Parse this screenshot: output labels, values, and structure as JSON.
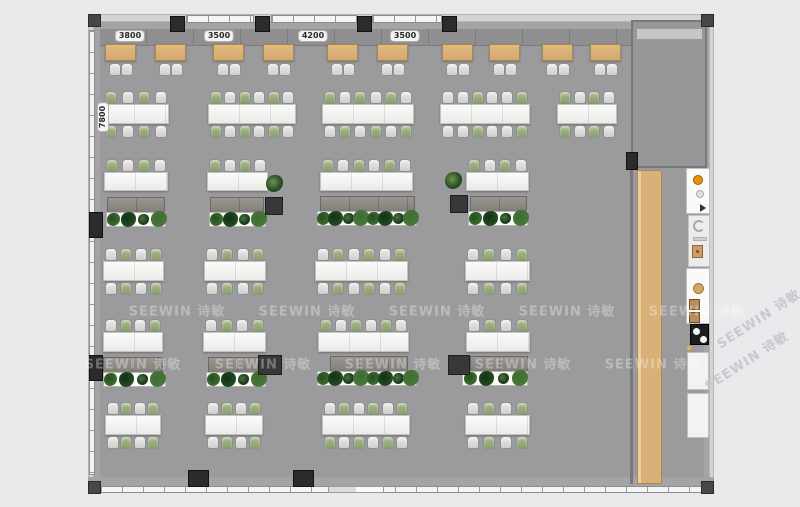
{
  "page": {
    "type": "office-floor-plan-rendering",
    "bg": "#e9eaec"
  },
  "watermark": {
    "text": "SEEWIN 诗敏",
    "color": "rgba(255,255,255,0.32)",
    "margin_color": "rgba(198,198,204,0.95)",
    "horizontal": [
      {
        "cx": 177,
        "cy": 310
      },
      {
        "cx": 307,
        "cy": 310
      },
      {
        "cx": 437,
        "cy": 310
      },
      {
        "cx": 567,
        "cy": 310
      },
      {
        "cx": 697,
        "cy": 310
      },
      {
        "cx": 133,
        "cy": 363
      },
      {
        "cx": 263,
        "cy": 363
      },
      {
        "cx": 393,
        "cy": 363
      },
      {
        "cx": 523,
        "cy": 363
      },
      {
        "cx": 653,
        "cy": 363
      }
    ],
    "diagonal": [
      {
        "cx": 758,
        "cy": 318,
        "rot": -33
      },
      {
        "cx": 746,
        "cy": 360,
        "rot": -33
      }
    ]
  },
  "dimensions": {
    "top": [
      {
        "label": "3800",
        "cx": 130,
        "cy": 36
      },
      {
        "label": "3500",
        "cx": 219,
        "cy": 36
      },
      {
        "label": "4200",
        "cx": 313,
        "cy": 36
      },
      {
        "label": "3500",
        "cx": 405,
        "cy": 36
      }
    ],
    "side": {
      "label": "7800",
      "cx": 103,
      "cy": 117,
      "rot": -90
    }
  },
  "palette": {
    "floor": "#9b9b9d",
    "wall_light": "#d4d4d6",
    "wall_dark": "#a4a4a6",
    "column": "#2b2b2d",
    "desk_tan": "#d8b078",
    "table_white": "#f5f5f3",
    "chair_white": "#d8d8d6",
    "chair_green": "#93a878",
    "credenza_gray": "#8e8a86",
    "plant_green": "#2c5124",
    "bench_wood": "#d8b078",
    "accent_orange": "#e8920a",
    "accent_yellow": "#e8c01c",
    "cooktop_black": "#1d1d1f"
  },
  "structure": {
    "columns_top_x": [
      170,
      255,
      357,
      442
    ],
    "columns_bottom_x": [
      188,
      293
    ],
    "columns_left_y": [
      212,
      355
    ],
    "corner_caps": [
      [
        88,
        14
      ],
      [
        701,
        14
      ],
      [
        88,
        481
      ],
      [
        701,
        481
      ]
    ],
    "corridor_column": [
      626,
      152
    ]
  },
  "furniture": {
    "row_y": {
      "1": {
        "desk": 44,
        "chairs": 63
      },
      "2": {
        "ct": 91,
        "t": 104,
        "th": 20,
        "cb": 125
      },
      "3": {
        "ct": 159,
        "t": 172,
        "th": 19
      },
      "4": {
        "ct": 248,
        "t": 261,
        "th": 20,
        "cb": 282
      },
      "5": {
        "ct": 319,
        "t": 332,
        "th": 20
      },
      "6": {
        "ct": 402,
        "t": 415,
        "th": 20,
        "cb": 436
      }
    },
    "tan_desk_xs": [
      105,
      155,
      213,
      263,
      327,
      377,
      442,
      489,
      542,
      590
    ],
    "clusters": [
      {
        "row": "2",
        "x": 103,
        "w": 66,
        "top": "GWGW",
        "bot": "GWGW"
      },
      {
        "row": "2",
        "x": 208,
        "w": 88,
        "top": "GWGWGW",
        "bot": "GWGWGW"
      },
      {
        "row": "2",
        "x": 322,
        "w": 92,
        "top": "GWGWGW",
        "bot": "WGWGWG"
      },
      {
        "row": "2",
        "x": 440,
        "w": 90,
        "top": "WWGWWG",
        "bot": "WWGWWG"
      },
      {
        "row": "2",
        "x": 557,
        "w": 60,
        "top": "GWGW",
        "bot": "GWGW"
      },
      {
        "row": "3",
        "x": 104,
        "w": 64,
        "top": "GWGW"
      },
      {
        "row": "3",
        "x": 207,
        "w": 61,
        "top": "GWGW"
      },
      {
        "row": "3",
        "x": 320,
        "w": 93,
        "top": "GWGWGW"
      },
      {
        "row": "3",
        "x": 466,
        "w": 63,
        "top": "GWGW"
      },
      {
        "row": "4",
        "x": 103,
        "w": 61,
        "top": "WGWG",
        "bot": "WGWG"
      },
      {
        "row": "4",
        "x": 204,
        "w": 62,
        "top": "WGWG",
        "bot": "WGWG"
      },
      {
        "row": "4",
        "x": 315,
        "w": 93,
        "top": "WGWGWG",
        "bot": "WGWGWG"
      },
      {
        "row": "4",
        "x": 465,
        "w": 65,
        "top": "WGWG",
        "bot": "WGWG"
      },
      {
        "row": "5",
        "x": 103,
        "w": 60,
        "top": "WGWG"
      },
      {
        "row": "5",
        "x": 203,
        "w": 63,
        "top": "WGWG"
      },
      {
        "row": "5",
        "x": 318,
        "w": 91,
        "top": "GWGWGW"
      },
      {
        "row": "5",
        "x": 466,
        "w": 64,
        "top": "WGWG"
      },
      {
        "row": "6",
        "x": 105,
        "w": 56,
        "top": "WGWG",
        "bot": "WGWG"
      },
      {
        "row": "6",
        "x": 205,
        "w": 58,
        "top": "WGWG",
        "bot": "WGWG"
      },
      {
        "row": "6",
        "x": 322,
        "w": 88,
        "top": "WGWGWG",
        "bot": "GWGWGW"
      },
      {
        "row": "6",
        "x": 465,
        "w": 65,
        "top": "WGWG",
        "bot": "WGWG"
      }
    ],
    "credenzas": [
      {
        "x": 107,
        "y": 197,
        "w": 58
      },
      {
        "x": 210,
        "y": 197,
        "w": 54
      },
      {
        "x": 320,
        "y": 196,
        "w": 95
      },
      {
        "x": 470,
        "y": 196,
        "w": 57
      },
      {
        "x": 103,
        "y": 357,
        "w": 60
      },
      {
        "x": 208,
        "y": 357,
        "w": 57
      },
      {
        "x": 330,
        "y": 356,
        "w": 78
      },
      {
        "x": 470,
        "y": 356,
        "w": 58
      }
    ],
    "planters": [
      {
        "x": 106,
        "y": 212,
        "w": 60,
        "n": 4
      },
      {
        "x": 209,
        "y": 212,
        "w": 57,
        "n": 4
      },
      {
        "x": 317,
        "y": 211,
        "w": 100,
        "n": 8
      },
      {
        "x": 468,
        "y": 211,
        "w": 60,
        "n": 4
      },
      {
        "x": 103,
        "y": 372,
        "w": 63,
        "n": 4
      },
      {
        "x": 206,
        "y": 372,
        "w": 60,
        "n": 4
      },
      {
        "x": 317,
        "y": 371,
        "w": 100,
        "n": 8
      },
      {
        "x": 462,
        "y": 371,
        "w": 66,
        "n": 4
      }
    ],
    "dark_cabinets": [
      {
        "x": 265,
        "y": 197,
        "w": 18,
        "h": 18
      },
      {
        "x": 450,
        "y": 195,
        "w": 18,
        "h": 18
      },
      {
        "x": 258,
        "y": 355,
        "w": 24,
        "h": 20
      },
      {
        "x": 448,
        "y": 355,
        "w": 22,
        "h": 20
      }
    ],
    "potted_plants": [
      {
        "x": 266,
        "y": 175
      },
      {
        "x": 445,
        "y": 172
      }
    ]
  }
}
